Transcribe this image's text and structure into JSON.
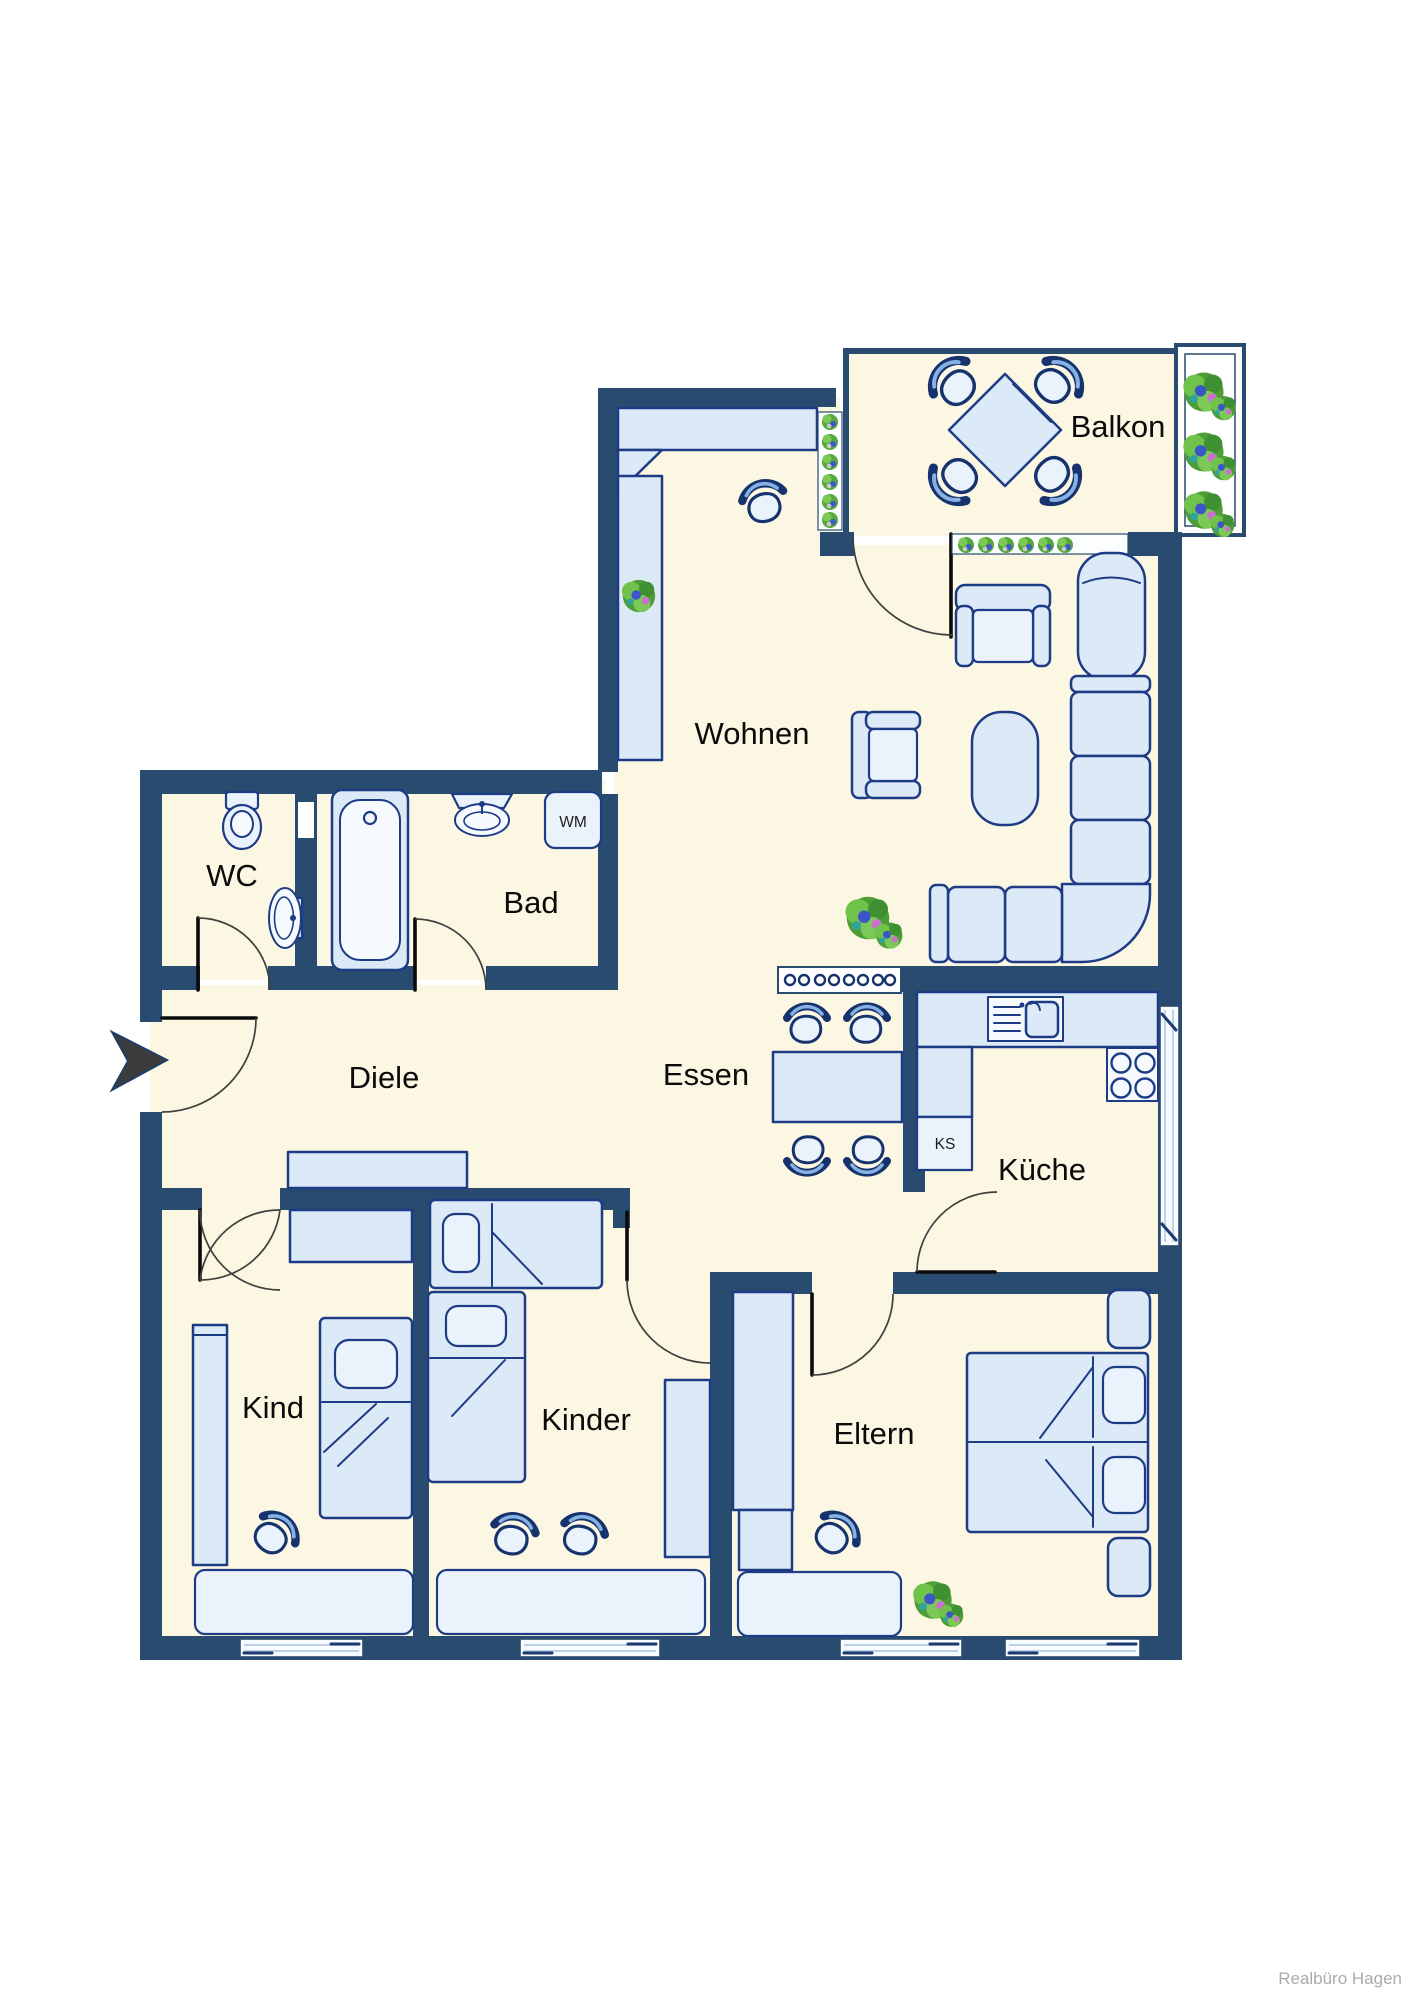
{
  "floorplan": {
    "labels": {
      "balkon": "Balkon",
      "wohnen": "Wohnen",
      "wc": "WC",
      "bad": "Bad",
      "diele": "Diele",
      "essen": "Essen",
      "kueche": "Küche",
      "kind": "Kind",
      "kinder": "Kinder",
      "eltern": "Eltern"
    },
    "appliances": {
      "wm": "WM",
      "ks": "KS"
    },
    "watermark": "Realbüro Hagen",
    "colors": {
      "wall": "#284B6F",
      "floor": "#FCF7E2",
      "furniture-fill": "#DCE9F7",
      "furniture-light": "#EAF2FB",
      "furniture-outline": "#1E3C86",
      "plant-green": "#5CAD42",
      "accent-blue-light": "#85B2E2"
    },
    "rooms": [
      {
        "id": "balkon",
        "furniture": [
          "dining-table",
          "chair",
          "chair",
          "chair",
          "chair",
          "flower-box",
          "flower-sill"
        ]
      },
      {
        "id": "wohnen",
        "furniture": [
          "wall-unit",
          "stool",
          "plant",
          "armchair",
          "armchair",
          "lounge-chair",
          "corner-sofa",
          "coffee-table",
          "plant",
          "flower-sill"
        ]
      },
      {
        "id": "wc",
        "furniture": [
          "toilet",
          "washbasin"
        ]
      },
      {
        "id": "bad",
        "furniture": [
          "bathtub",
          "washbasin",
          "washing-machine"
        ]
      },
      {
        "id": "diele",
        "furniture": [
          "cabinet"
        ]
      },
      {
        "id": "essen",
        "furniture": [
          "dining-table",
          "chair",
          "chair",
          "chair",
          "chair",
          "sideboard"
        ]
      },
      {
        "id": "kueche",
        "furniture": [
          "counter",
          "sink",
          "refrigerator",
          "stove"
        ]
      },
      {
        "id": "kind",
        "furniture": [
          "bed",
          "wardrobe",
          "cabinet",
          "desk",
          "chair"
        ]
      },
      {
        "id": "kinder",
        "furniture": [
          "bed",
          "bed",
          "wardrobe",
          "desk",
          "chair",
          "chair"
        ]
      },
      {
        "id": "eltern",
        "furniture": [
          "double-bed",
          "nightstand",
          "nightstand",
          "wardrobe",
          "desk",
          "chair",
          "plant"
        ]
      }
    ],
    "entrance": {
      "marker": "arrow-right"
    }
  }
}
